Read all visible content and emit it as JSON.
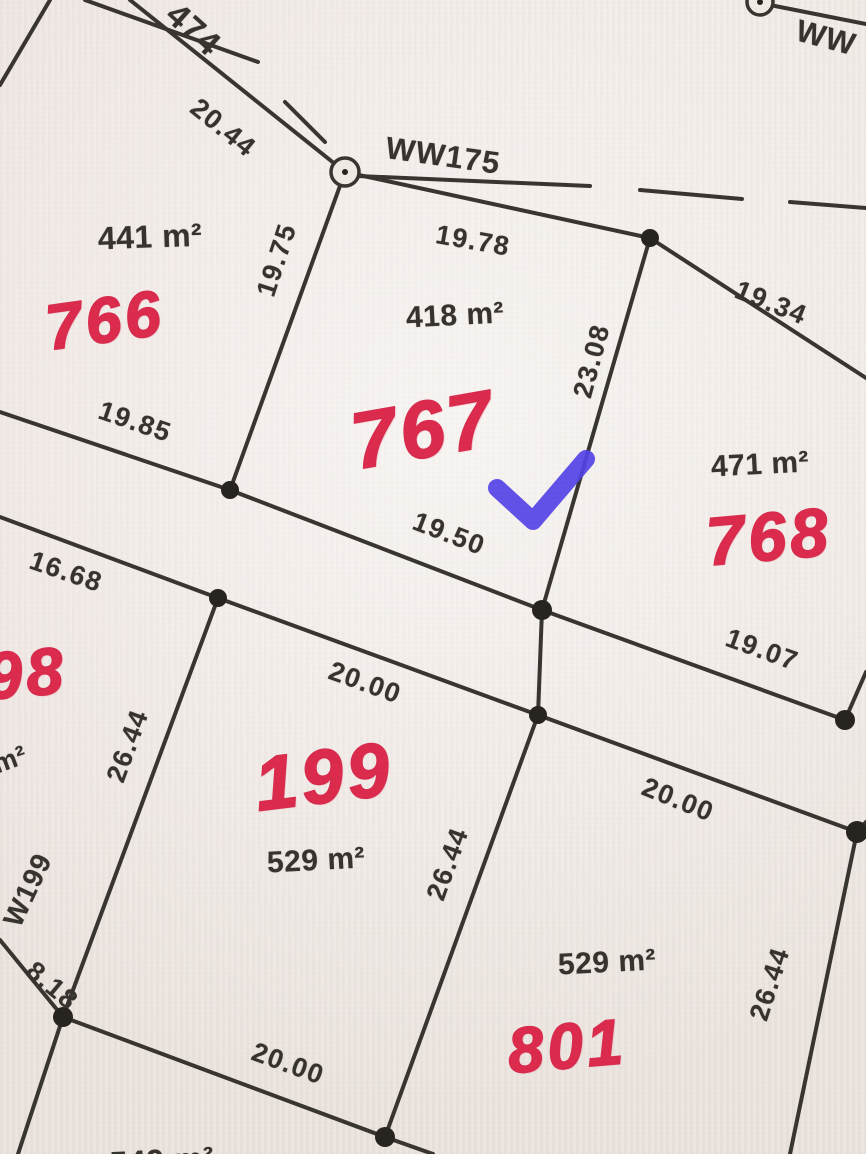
{
  "map": {
    "kind": "scanned cadastral plat with handwritten lot numbers",
    "colors": {
      "paper": "#f0eae5",
      "ink": "#35312c",
      "handwriting_red": "#dc2a4c",
      "check_blue": "#5242e6"
    },
    "roads": [
      {
        "name": "474",
        "note": "partial road label, top-left, crossed by dashed centerline"
      },
      {
        "name": "WW175",
        "note": "dashed road centerline running right from junction circle"
      },
      {
        "name": "WW",
        "note": "partial road label, clipped at top-right edge"
      },
      {
        "name": "W199",
        "note": "partial road label, clipped at left edge"
      }
    ],
    "lots": [
      {
        "number": "766",
        "area": "441 m²",
        "marked": false
      },
      {
        "number": "767",
        "area": "418 m²",
        "marked": true
      },
      {
        "number": "768",
        "area": "471 m²",
        "marked": false
      },
      {
        "number": "199",
        "area": "529 m²",
        "marked": false
      },
      {
        "number": "801",
        "area": "529 m²",
        "marked": false
      },
      {
        "number": "98",
        "area": "m²",
        "marked": false,
        "note": "clipped at left edge"
      },
      {
        "number": "",
        "area": "549 m²",
        "marked": false,
        "note": "clipped at bottom edge"
      }
    ],
    "annotation": {
      "type": "blue checkmark",
      "on_lot": "767",
      "color": "#5242e6"
    }
  },
  "labels": {
    "road_474": "474",
    "dim_2044": "20.44",
    "road_ww175": "WW175",
    "road_ww": "WW",
    "area_766": "441 m²",
    "lot_766": "766",
    "dim_1985": "19.85",
    "dim_1975": "19.75",
    "dim_1978": "19.78",
    "area_767": "418 m²",
    "lot_767": "767",
    "dim_2308": "23.08",
    "dim_1950": "19.50",
    "dim_1934": "19.34",
    "area_768": "471 m²",
    "lot_768": "768",
    "dim_1907": "19.07",
    "dim_1668": "16.68",
    "lot_798_partial": "98",
    "area_798_partial": "m²",
    "dim_2644_w": "26.44",
    "road_w199": "W199",
    "dim_818": "8.18",
    "dim_2000_n": "20.00",
    "lot_199": "199",
    "area_199": "529 m²",
    "dim_2644_e": "26.44",
    "dim_2000_ne": "20.00",
    "area_801": "529 m²",
    "lot_801": "801",
    "dim_2644_se": "26.44",
    "dim_2000_s": "20.00",
    "area_bottom_partial": "549 m²"
  }
}
